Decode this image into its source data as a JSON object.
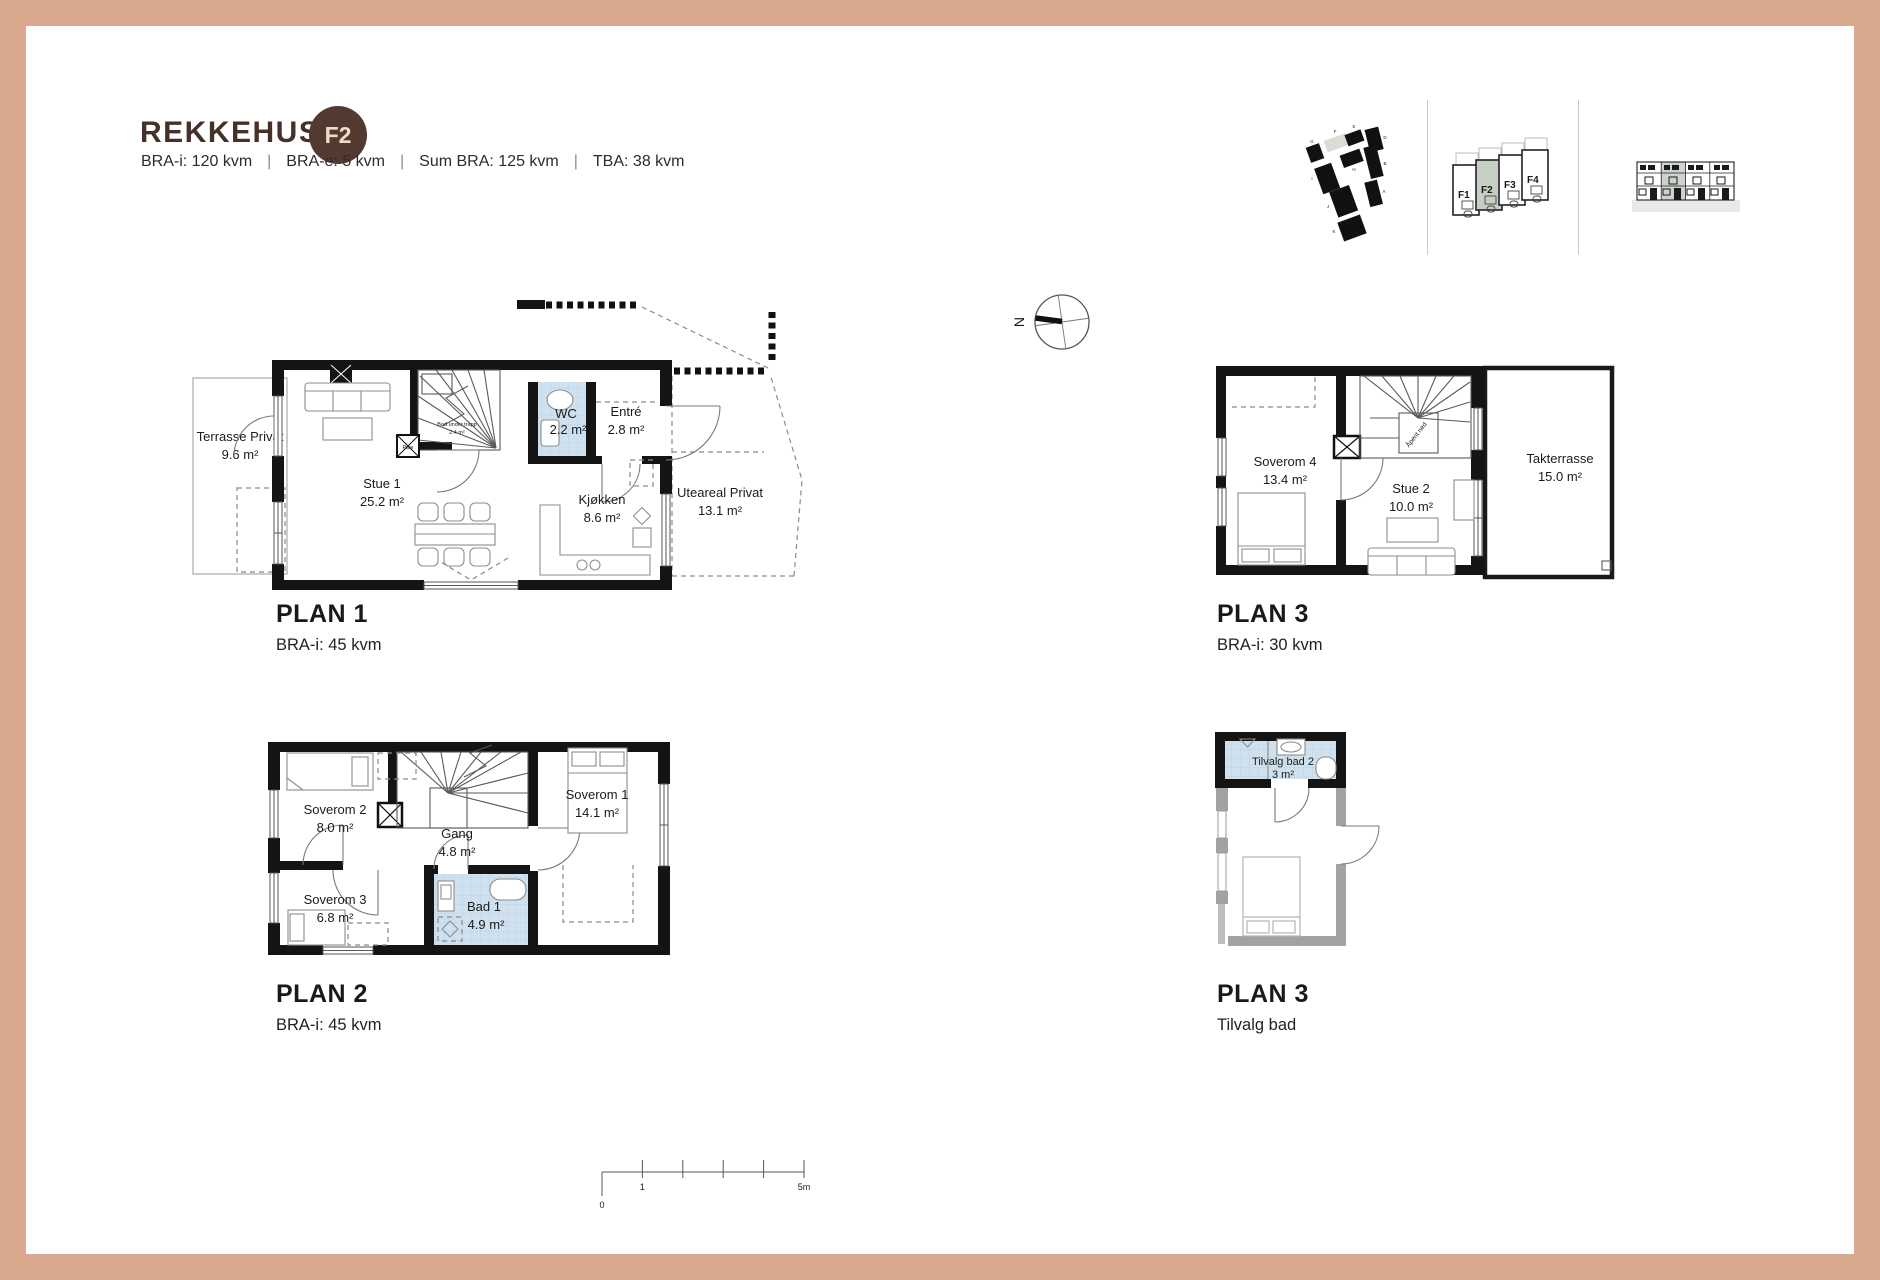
{
  "theme": {
    "frame_color": "#d9a98e",
    "brand_brown": "#46312a",
    "badge_bg": "#523a31",
    "badge_fg": "#eedcc6",
    "wetroom_blue": "#cfe1ee",
    "highlight_green": "#c6cfc3",
    "wall_black": "#141414"
  },
  "header": {
    "title": "REKKEHUS:",
    "badge": "F2",
    "separator": "|",
    "meta": [
      "BRA-i: 120 kvm",
      "BRA-e: 5 kvm",
      "Sum BRA: 125 kvm",
      "TBA: 38 kvm"
    ]
  },
  "locator": {
    "site": {
      "highlighted": "F",
      "labels": {
        "g": "G",
        "f": "F",
        "e": "E",
        "d": "D",
        "b": "B",
        "h": "H",
        "i": "I",
        "a": "A",
        "j": "J",
        "k": "K"
      }
    },
    "units": {
      "highlighted": "F2",
      "f1": "F1",
      "f2": "F2",
      "f3": "F3",
      "f4": "F4"
    }
  },
  "compass": {
    "north": "N"
  },
  "plan1": {
    "title": "PLAN 1",
    "subtitle": "BRA-i: 45 kvm",
    "rooms": {
      "terrasse": {
        "name": "Terrasse Privat",
        "area": "9.6 m²"
      },
      "stue": {
        "name": "Stue 1",
        "area": "25.2 m²"
      },
      "wc": {
        "name": "WC",
        "area": "2.2 m²"
      },
      "entre": {
        "name": "Entré",
        "area": "2.8 m²"
      },
      "kjokken": {
        "name": "Kjøkken",
        "area": "8.6 m²"
      },
      "uteareal": {
        "name": "Uteareal Privat",
        "area": "13.1 m²"
      },
      "bod": {
        "name": "Bod under trapp",
        "area": "2.4 m²"
      },
      "pipe": {
        "name": "Pipe"
      }
    }
  },
  "plan2": {
    "title": "PLAN 2",
    "subtitle": "BRA-i: 45 kvm",
    "rooms": {
      "soverom2": {
        "name": "Soverom 2",
        "area": "8.0 m²"
      },
      "soverom3": {
        "name": "Soverom 3",
        "area": "6.8 m²"
      },
      "gang": {
        "name": "Gang",
        "area": "4.8 m²"
      },
      "bad1": {
        "name": "Bad 1",
        "area": "4.9 m²"
      },
      "soverom1": {
        "name": "Soverom 1",
        "area": "14.1 m²"
      }
    }
  },
  "plan3": {
    "title": "PLAN 3",
    "subtitle": "BRA-i: 30 kvm",
    "rooms": {
      "soverom4": {
        "name": "Soverom 4",
        "area": "13.4 m²"
      },
      "stue2": {
        "name": "Stue 2",
        "area": "10.0 m²"
      },
      "takterrasse": {
        "name": "Takterrasse",
        "area": "15.0 m²"
      },
      "apent": {
        "name": "Åpent ned"
      }
    }
  },
  "plan3b": {
    "title": "PLAN 3",
    "subtitle": "Tilvalg bad",
    "rooms": {
      "tilvalgbad": {
        "name": "Tilvalg bad 2",
        "area": "3 m²"
      }
    }
  },
  "scalebar": {
    "zero": "0",
    "one": "1",
    "five": "5m"
  }
}
